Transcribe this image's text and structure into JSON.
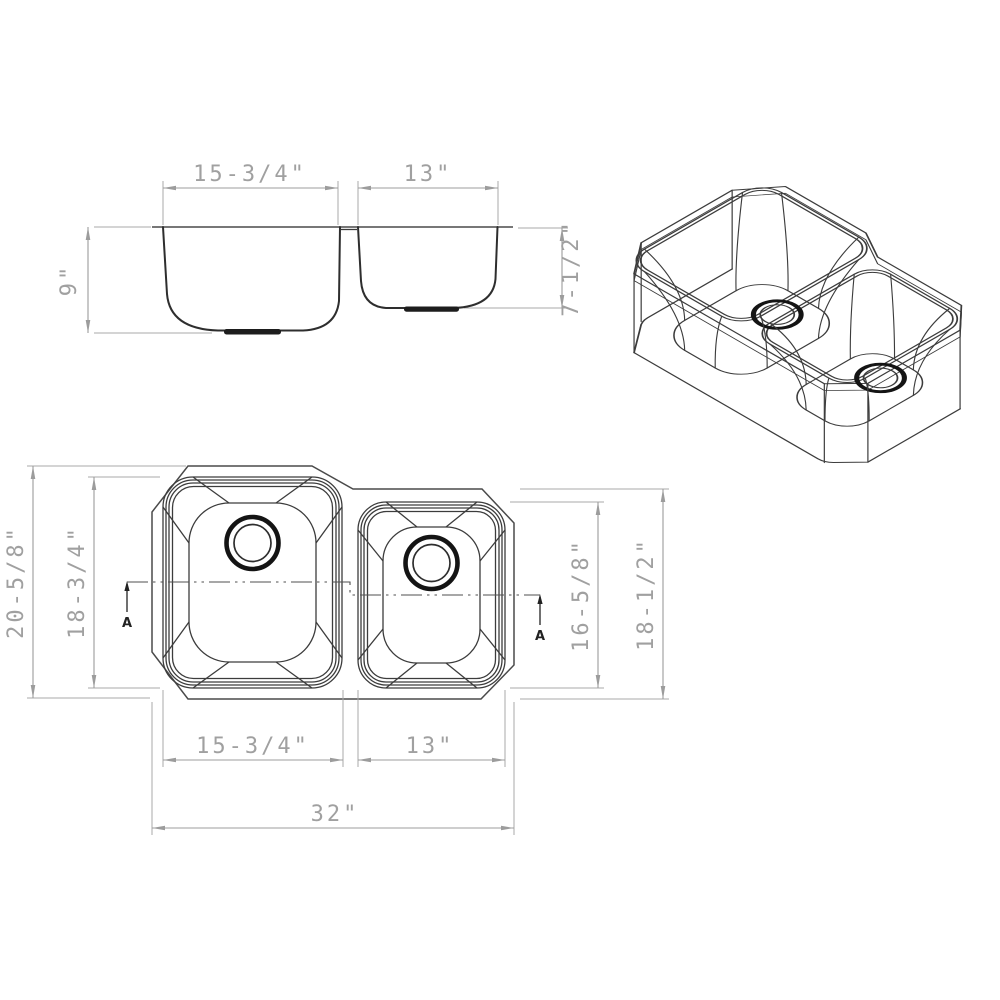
{
  "colors": {
    "profile_line": "#2e2e2e",
    "dimension_line": "#9c9c9c",
    "drain_line": "#141414",
    "background": "#ffffff"
  },
  "views": {
    "elevation": {
      "dims": {
        "left_bowl_width": "15-3/4\"",
        "right_bowl_width": "13\"",
        "left_bowl_depth": "9\"",
        "right_bowl_depth": "7-1/2\""
      }
    },
    "plan": {
      "dims": {
        "overall_length_left": "20-5/8\"",
        "left_bowl_length": "18-3/4\"",
        "right_bowl_length": "16-5/8\"",
        "overall_length_right": "18-1/2\"",
        "left_bowl_width": "15-3/4\"",
        "right_bowl_width": "13\"",
        "overall_width": "32\""
      },
      "section_marker": "A"
    }
  }
}
